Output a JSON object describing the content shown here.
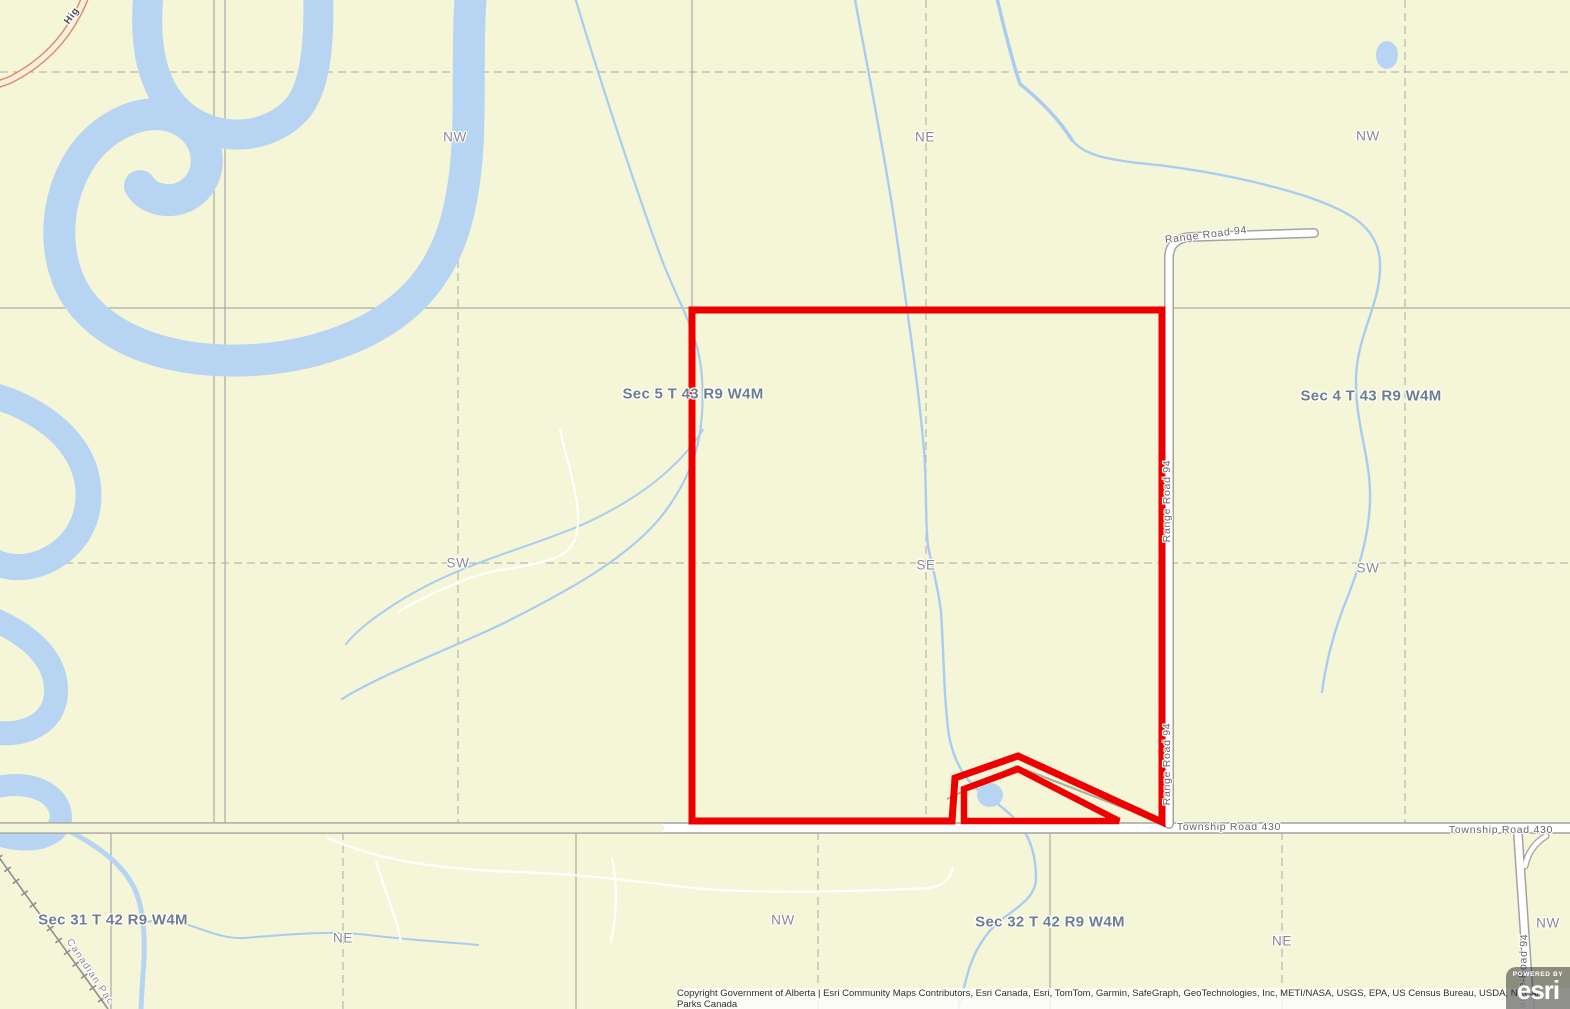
{
  "map": {
    "section_labels": [
      {
        "text": "Sec 5 T 43 R9 W4M"
      },
      {
        "text": "Sec 4 T 43 R9 W4M"
      },
      {
        "text": "Sec 31 T 42 R9 W4M"
      },
      {
        "text": "Sec 32 T 42 R9 W4M"
      }
    ],
    "quarter_labels": [
      "NW",
      "NE",
      "NW",
      "SW",
      "SE",
      "SW",
      "NE",
      "NW",
      "NE",
      "NW"
    ],
    "road_labels": {
      "township_road": "Township Road 430",
      "range_road": "Range Road 94",
      "highway_partial": "Hig",
      "railway_partial": "Canadian Pac"
    },
    "colors": {
      "background": "#f5f5d8",
      "water": "#b7d5f2",
      "stream": "#a9cdf0",
      "parcel_outline": "#ee0000",
      "road_fill": "#ffffff",
      "road_casing": "#a3a3a3",
      "grid_line": "#9c9c9c",
      "highway": "#dd8868"
    }
  },
  "attribution": {
    "text": "Copyright Government of Alberta | Esri Community Maps Contributors, Esri Canada, Esri, TomTom, Garmin, SafeGraph, GeoTechnologies, Inc, METI/NASA, USGS, EPA, US Census Bureau, USDA, NRCan, Parks Canada"
  },
  "logo": {
    "powered_by": "POWERED BY",
    "brand": "esri"
  }
}
